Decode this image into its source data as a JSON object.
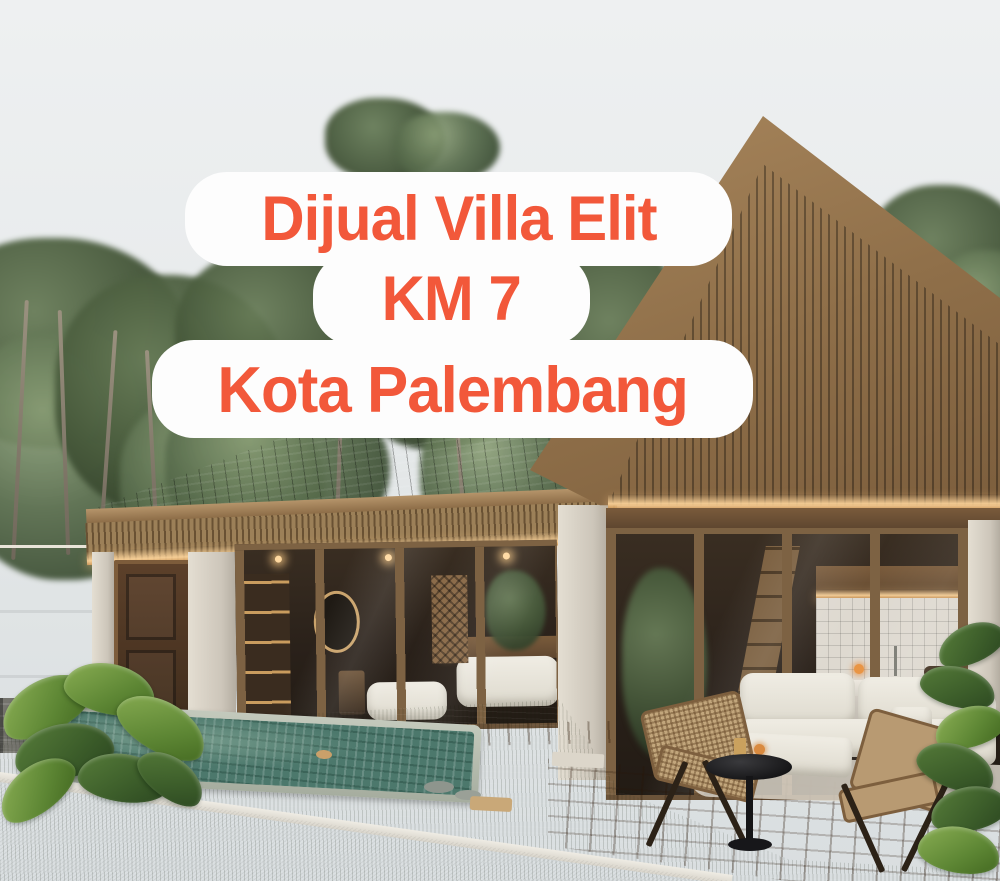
{
  "overlay": {
    "line1": "Dijual Villa Elit",
    "line2": "KM 7",
    "line3": "Kota Palembang",
    "text_color": "#F2583A",
    "bubble_color": "#FDFDFD"
  },
  "scene": {
    "description": "3D exterior rendering of a modern tropical villa: dark-wood A-frame gable wing with glass walls, gray-shingle flat wing, swimming pool, wooden deck with white sofa, rattan folding chairs and round side table, lawn, boundary wall, garden plants and a road in the foreground",
    "palette": {
      "sky": "#E8EBEC",
      "gable_siding": "#473A2C",
      "roof_fascia": "#96744C",
      "shingle_roof": "#3E464C",
      "led_glow": "#FFD69C",
      "lawn": "#64733E",
      "pool_water": "#4C786C",
      "deck_wood": "#9A7A57",
      "road": "#BDB9B2",
      "wall": "#D5CFC3"
    }
  }
}
